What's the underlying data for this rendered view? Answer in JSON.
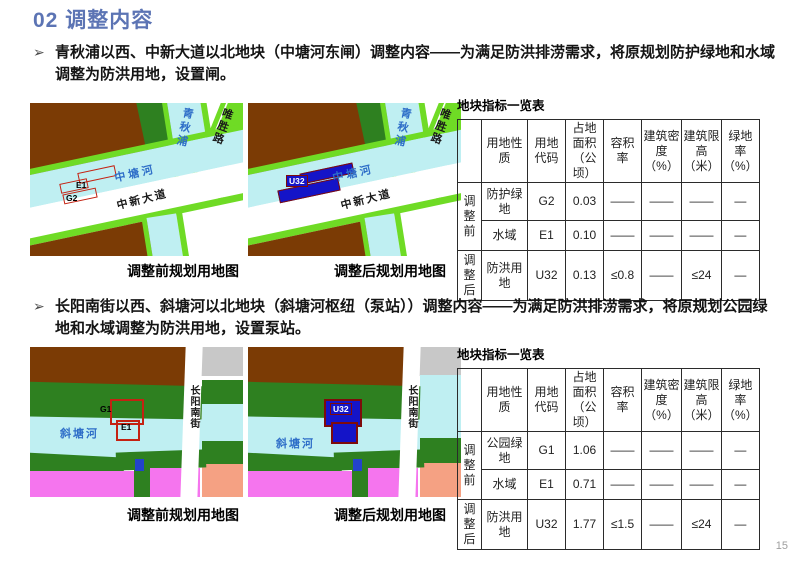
{
  "title": "02 调整内容",
  "page_number": "15",
  "sections": [
    {
      "bullet_marker": "➢",
      "paragraph": "青秋浦以西、中新大道以北地块（中塘河东闸）调整内容——为满足防洪排涝需求，将原规划防护绿地和水域调整为防洪用地，设置闸。",
      "map_before_caption": "调整前规划用地图",
      "map_after_caption": "调整后规划用地图",
      "map_labels": {
        "river_vertical": "青秋浦",
        "road_side": "唯胜路",
        "river_main": "中塘河",
        "road_main": "中新大道"
      },
      "parcels_before": [
        "E1",
        "G2"
      ],
      "parcel_after": "U32",
      "table": {
        "title": "地块指标一览表",
        "headers": [
          "用地性质",
          "用地代码",
          "占地面积（公顷）",
          "容积率",
          "建筑密度（%）",
          "建筑限高（米）",
          "绿地率（%）"
        ],
        "groups": [
          {
            "label": "调整前",
            "rows": [
              {
                "cells": [
                  "防护绿地",
                  "G2",
                  "0.03",
                  "——",
                  "——",
                  "——",
                  "—"
                ]
              },
              {
                "cells": [
                  "水域",
                  "E1",
                  "0.10",
                  "——",
                  "——",
                  "——",
                  "—"
                ]
              }
            ]
          },
          {
            "label": "调整后",
            "rows": [
              {
                "cells": [
                  "防洪用地",
                  "U32",
                  "0.13",
                  "≤0.8",
                  "——",
                  "≤24",
                  "—"
                ]
              }
            ]
          }
        ]
      }
    },
    {
      "bullet_marker": "➢",
      "paragraph": "长阳南街以西、斜塘河以北地块（斜塘河枢纽（泵站））调整内容——为满足防洪排涝需求，将原规划公园绿地和水域调整为防洪用地，设置泵站。",
      "map_before_caption": "调整前规划用地图",
      "map_after_caption": "调整后规划用地图",
      "map_labels": {
        "road_side": "长阳南街",
        "river_main": "斜塘河"
      },
      "parcels_before": [
        "G1",
        "E1"
      ],
      "parcel_after": "U32",
      "table": {
        "title": "地块指标一览表",
        "headers": [
          "用地性质",
          "用地代码",
          "占地面积（公顷）",
          "容积率",
          "建筑密度（%）",
          "建筑限高（米）",
          "绿地率（%）"
        ],
        "groups": [
          {
            "label": "调整前",
            "rows": [
              {
                "cells": [
                  "公园绿地",
                  "G1",
                  "1.06",
                  "——",
                  "——",
                  "——",
                  "—"
                ]
              },
              {
                "cells": [
                  "水域",
                  "E1",
                  "0.71",
                  "——",
                  "——",
                  "——",
                  "—"
                ]
              }
            ]
          },
          {
            "label": "调整后",
            "rows": [
              {
                "cells": [
                  "防洪用地",
                  "U32",
                  "1.77",
                  "≤1.5",
                  "——",
                  "≤24",
                  "—"
                ]
              }
            ]
          }
        ]
      }
    }
  ]
}
